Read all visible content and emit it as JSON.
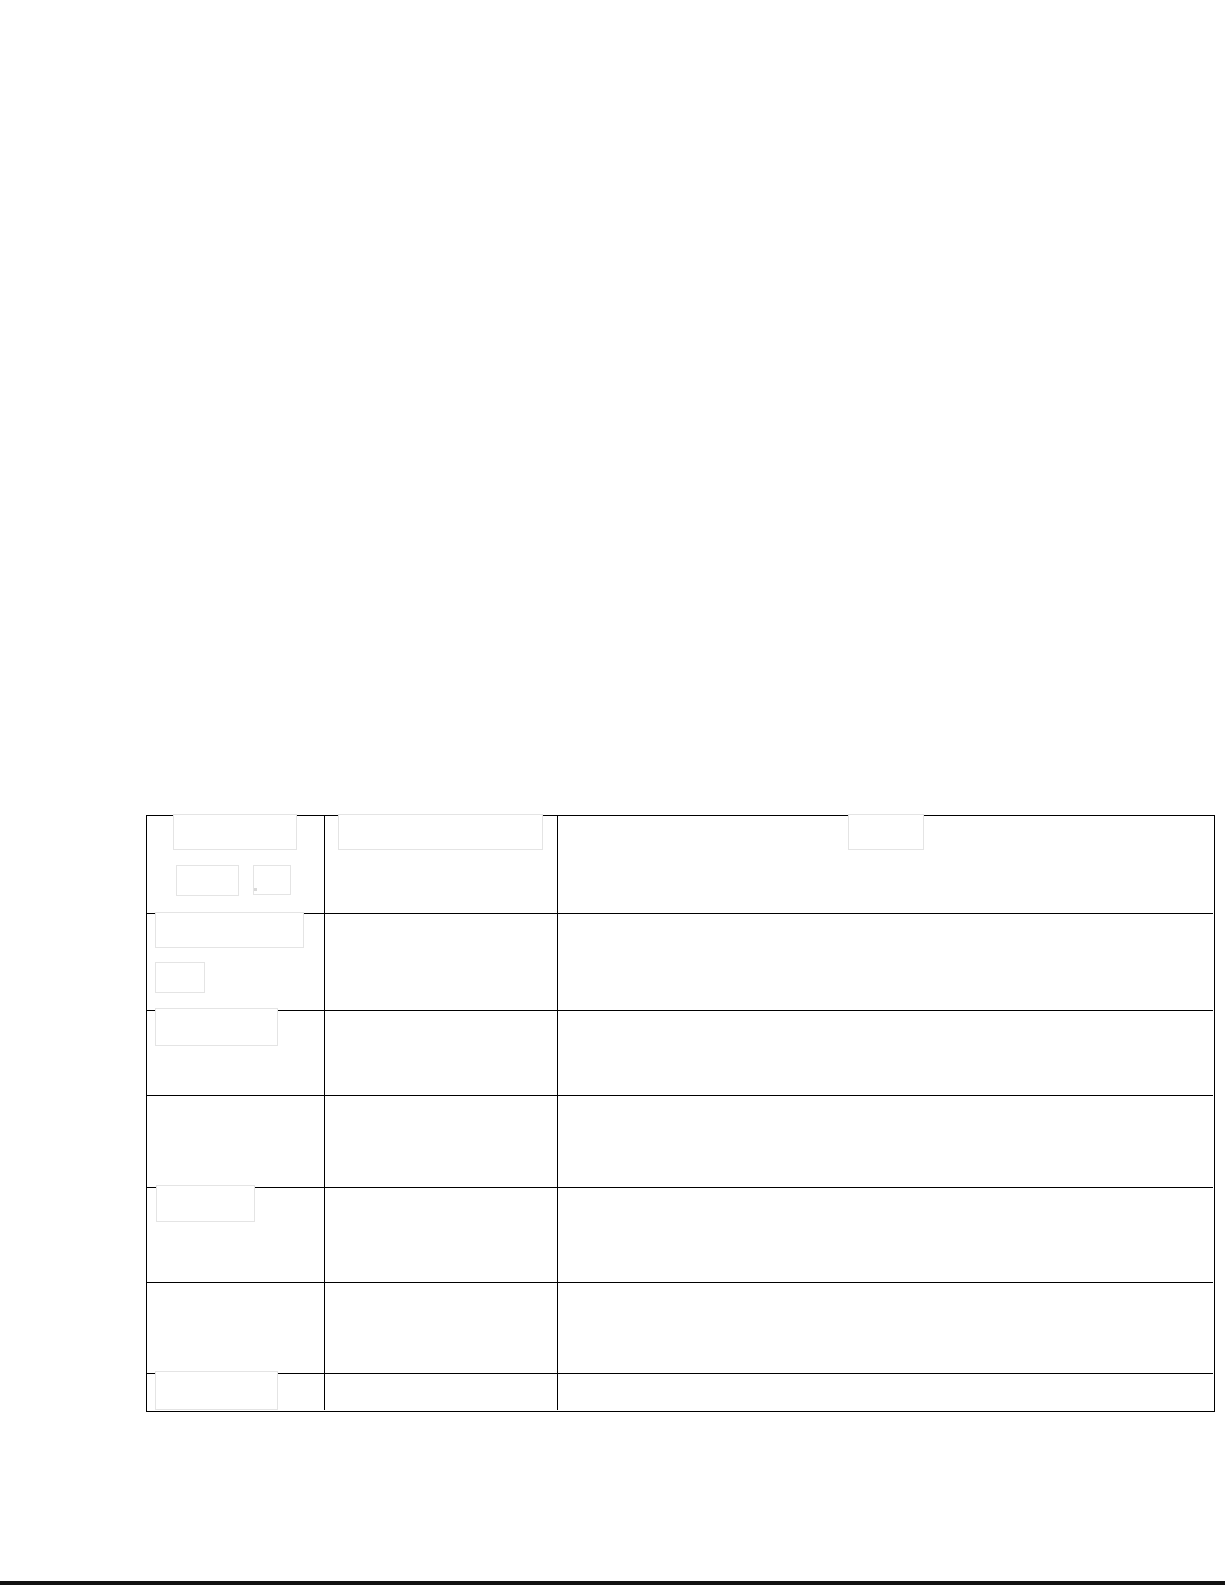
{
  "document": {
    "kind": "scanned-form-page-with-redactions",
    "background": "#ffffff",
    "table": {
      "left": 146,
      "top": 815,
      "rows": 7,
      "cols": 3,
      "col_widths": [
        178,
        233,
        655
      ],
      "row_heights": [
        98,
        97,
        85,
        92,
        95,
        91,
        36
      ],
      "line_color": "#000000",
      "line_width": 1.5,
      "cell_text": [
        [
          "",
          "",
          ""
        ],
        [
          "",
          "",
          ""
        ],
        [
          "",
          "",
          ""
        ],
        [
          "",
          "",
          ""
        ],
        [
          "",
          "",
          ""
        ],
        [
          "",
          "",
          ""
        ],
        [
          "",
          "",
          ""
        ]
      ]
    },
    "redactions": {
      "fill": "#ffffff",
      "border_color": "#e4e4e4",
      "border_width": 1.5,
      "boxes": [
        {
          "id": "row1-col1-a",
          "x": 173,
          "y": 814,
          "w": 124,
          "h": 36
        },
        {
          "id": "row1-col1-b",
          "x": 176,
          "y": 865,
          "w": 63,
          "h": 31
        },
        {
          "id": "row1-col1-c",
          "x": 253,
          "y": 865,
          "w": 38,
          "h": 30
        },
        {
          "id": "row1-col2",
          "x": 338,
          "y": 814,
          "w": 205,
          "h": 36
        },
        {
          "id": "row1-col3",
          "x": 848,
          "y": 814,
          "w": 76,
          "h": 36
        },
        {
          "id": "row2-col1-a",
          "x": 155,
          "y": 912,
          "w": 149,
          "h": 36
        },
        {
          "id": "row2-col1-b",
          "x": 155,
          "y": 962,
          "w": 50,
          "h": 31
        },
        {
          "id": "row3-col1",
          "x": 155,
          "y": 1008,
          "w": 123,
          "h": 38
        },
        {
          "id": "row5-col1",
          "x": 156,
          "y": 1185,
          "w": 99,
          "h": 37
        },
        {
          "id": "row7-col1",
          "x": 155,
          "y": 1371,
          "w": 123,
          "h": 39
        }
      ]
    },
    "stray_mark": {
      "x": 254,
      "y": 888,
      "w": 3,
      "h": 3,
      "color": "#d8d8d8"
    },
    "bottom_edge_bar": {
      "x": 0,
      "y": 1581,
      "w": 1225,
      "h": 4,
      "color": "#121212"
    }
  }
}
